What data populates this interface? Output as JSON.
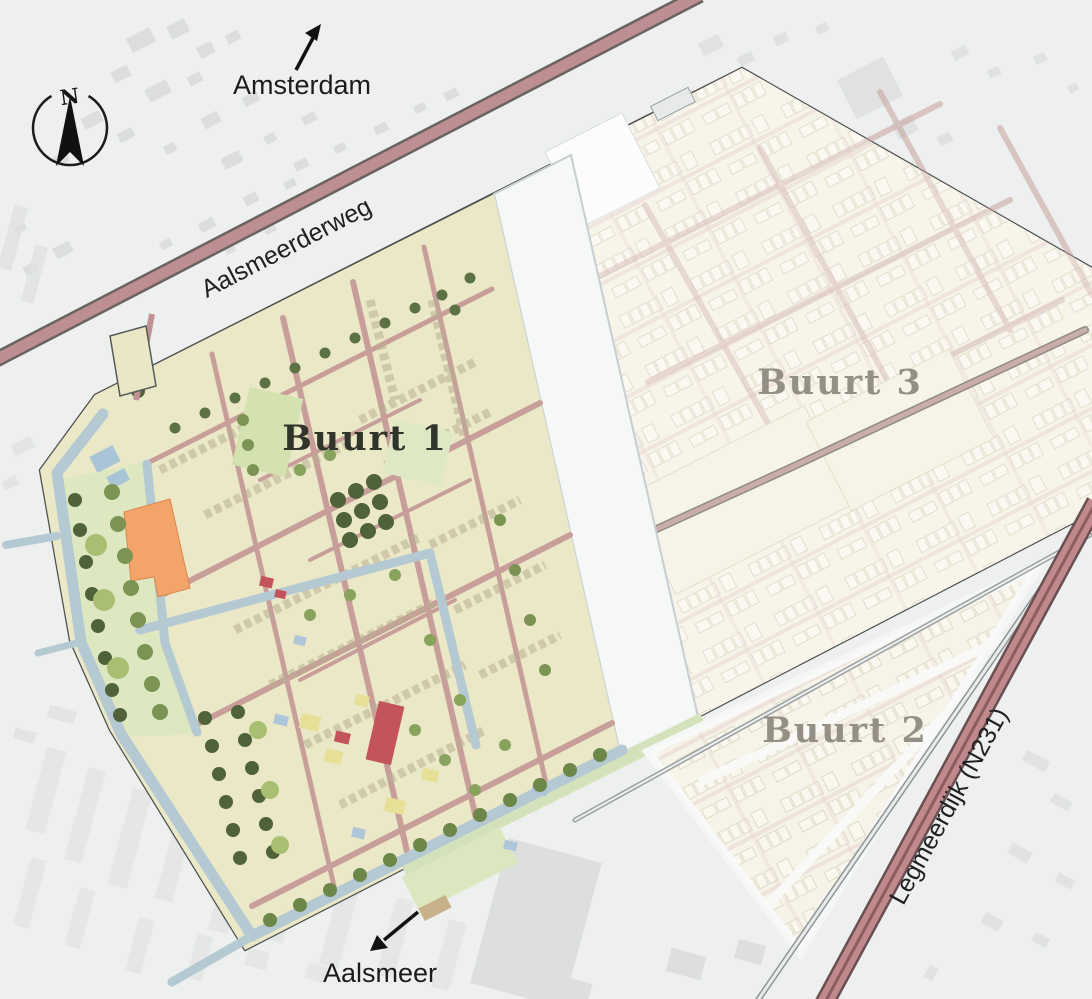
{
  "map": {
    "compass": {
      "label": "N"
    },
    "directions": {
      "north_destination": "Amsterdam",
      "south_destination": "Aalsmeer"
    },
    "roads": {
      "main_road_top": "Aalsmeerderweg",
      "main_road_right": "Legmeerdijk (N231)"
    },
    "neighborhoods": {
      "buurt1": "Buurt 1",
      "buurt2": "Buurt 2",
      "buurt3": "Buurt 3"
    },
    "colors": {
      "background": "#edf0ee",
      "outside_buildings": "#dfe2e0",
      "plan_area_beige": "#eae7c6",
      "faded_area_beige": "#f3efdf",
      "water_canal": "#b5c9d3",
      "park_green": "#dde7c0",
      "road_pink": "#bd8e92",
      "street_pink": "#c89e9a",
      "accent_orange": "#f3a469",
      "accent_red": "#c3545c",
      "tree_dark": "#4f6239",
      "label_grey": "#8d887c",
      "label_dark": "#30342a"
    }
  }
}
